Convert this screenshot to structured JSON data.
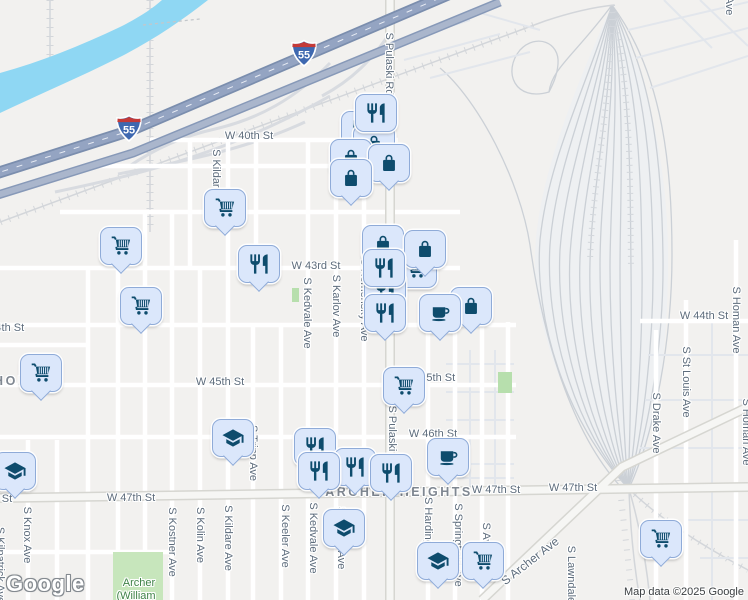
{
  "branding": {
    "logo": "Google",
    "attribution": "Map data ©2025 Google"
  },
  "route_shield": "55",
  "colors": {
    "land": "#f2f1ef",
    "water": "#8fd7f3",
    "park": "#c7e6bc",
    "highway": "#94a4c2",
    "pin_fill": "#dbe7fb",
    "pin_border": "#8fabd8",
    "pin_icon": "#0e4c6d",
    "street_label": "#5d6c7c",
    "neighborhood_label": "#7f8791"
  },
  "shields": [
    {
      "x": 304,
      "y": 56
    },
    {
      "x": 129,
      "y": 131
    }
  ],
  "labels": [
    {
      "text": "W 40th St",
      "x": 249,
      "y": 136,
      "dir": "h"
    },
    {
      "text": "W 43rd St",
      "x": 316,
      "y": 266,
      "dir": "h"
    },
    {
      "text": "W 44th St",
      "x": 0,
      "y": 328,
      "dir": "h"
    },
    {
      "text": "W 44th St",
      "x": 704,
      "y": 316,
      "dir": "h"
    },
    {
      "text": "W 45th St",
      "x": 220,
      "y": 382,
      "dir": "h"
    },
    {
      "text": "W 45th St",
      "x": 431,
      "y": 378,
      "dir": "h"
    },
    {
      "text": "W 46th St",
      "x": 433,
      "y": 434,
      "dir": "h"
    },
    {
      "text": "W 47th St",
      "x": -12,
      "y": 499,
      "dir": "h"
    },
    {
      "text": "W 47th St",
      "x": 131,
      "y": 498,
      "dir": "h"
    },
    {
      "text": "W 47th St",
      "x": 496,
      "y": 490,
      "dir": "h"
    },
    {
      "text": "W 47th St",
      "x": 573,
      "y": 488,
      "dir": "h"
    },
    {
      "text": "S Pulaski Rd",
      "x": 389,
      "y": 64,
      "dir": "v"
    },
    {
      "text": "S Pulaski Rd",
      "x": 392,
      "y": 437,
      "dir": "v"
    },
    {
      "text": "S Kildare Ave",
      "x": 216,
      "y": 182,
      "dir": "v"
    },
    {
      "text": "S Kedvale Ave",
      "x": 307,
      "y": 313,
      "dir": "v"
    },
    {
      "text": "S Karlov Ave",
      "x": 336,
      "y": 306,
      "dir": "v"
    },
    {
      "text": "S Komensky Ave",
      "x": 364,
      "y": 300,
      "dir": "v"
    },
    {
      "text": "S Tripp Ave",
      "x": 253,
      "y": 453,
      "dir": "v"
    },
    {
      "text": "S Knox Ave",
      "x": 27,
      "y": 535,
      "dir": "v"
    },
    {
      "text": "S Kilpatrick Ave",
      "x": 0,
      "y": 565,
      "dir": "v"
    },
    {
      "text": "S Kostner Ave",
      "x": 172,
      "y": 542,
      "dir": "v"
    },
    {
      "text": "S Kolin Ave",
      "x": 200,
      "y": 535,
      "dir": "v"
    },
    {
      "text": "S Kildare Ave",
      "x": 228,
      "y": 538,
      "dir": "v"
    },
    {
      "text": "S Keeler Ave",
      "x": 285,
      "y": 536,
      "dir": "v"
    },
    {
      "text": "S Kedvale Ave",
      "x": 313,
      "y": 538,
      "dir": "v"
    },
    {
      "text": "S Karlov Ave",
      "x": 341,
      "y": 538,
      "dir": "v"
    },
    {
      "text": "S Harding Ave",
      "x": 428,
      "y": 532,
      "dir": "v"
    },
    {
      "text": "S Springfield Ave",
      "x": 458,
      "y": 545,
      "dir": "v"
    },
    {
      "text": "S Avers Ave",
      "x": 486,
      "y": 552,
      "dir": "v"
    },
    {
      "text": "S Lawndale Ave",
      "x": 571,
      "y": 585,
      "dir": "v"
    },
    {
      "text": "S Drake Ave",
      "x": 656,
      "y": 423,
      "dir": "v"
    },
    {
      "text": "S St Louis Ave",
      "x": 686,
      "y": 382,
      "dir": "v"
    },
    {
      "text": "S Homan Ave",
      "x": 736,
      "y": 320,
      "dir": "v"
    },
    {
      "text": "S Homan Ave",
      "x": 746,
      "y": 432,
      "dir": "v"
    },
    {
      "text": "Ave",
      "x": 729,
      "y": 6,
      "dir": "v"
    },
    {
      "text": "S Archer Ave",
      "x": 530,
      "y": 561,
      "dir": "h",
      "angle": -38,
      "cls": "street-lg"
    },
    {
      "text": "ARCHER HEIGHTS",
      "x": 399,
      "y": 492,
      "dir": "h",
      "cls": "nbhd"
    },
    {
      "text": "HOL",
      "x": 11,
      "y": 381,
      "dir": "h",
      "cls": "nbhd"
    },
    {
      "text": "Archer",
      "x": 139,
      "y": 583,
      "dir": "h",
      "cls": "park"
    },
    {
      "text": "(William",
      "x": 136,
      "y": 596,
      "dir": "h",
      "cls": "park"
    }
  ],
  "markers": [
    {
      "type": "restaurant",
      "x": 375,
      "y": 112,
      "z": 9,
      "tail": false
    },
    {
      "type": "restaurant",
      "x": 361,
      "y": 129,
      "z": 4
    },
    {
      "type": "bag",
      "x": 373,
      "y": 143,
      "z": 5,
      "tail": false
    },
    {
      "type": "bag",
      "x": 350,
      "y": 157,
      "z": 6,
      "tail": false
    },
    {
      "type": "bag",
      "x": 388,
      "y": 162,
      "z": 7
    },
    {
      "type": "bag",
      "x": 350,
      "y": 177,
      "z": 8
    },
    {
      "type": "bag",
      "x": 382,
      "y": 243,
      "z": 1,
      "tail": false
    },
    {
      "type": "cart",
      "x": 415,
      "y": 268,
      "z": 2,
      "tail": false
    },
    {
      "type": "restaurant",
      "x": 384,
      "y": 289,
      "z": 3,
      "tail": false
    },
    {
      "type": "bag",
      "x": 424,
      "y": 248,
      "z": 4
    },
    {
      "type": "restaurant",
      "x": 383,
      "y": 267,
      "z": 6,
      "tail": false
    },
    {
      "type": "bag",
      "x": 470,
      "y": 305,
      "z": 5
    },
    {
      "type": "cafe",
      "x": 439,
      "y": 312,
      "z": 7
    },
    {
      "type": "restaurant",
      "x": 384,
      "y": 312,
      "z": 8
    },
    {
      "type": "cart",
      "x": 224,
      "y": 207,
      "z": 3
    },
    {
      "type": "cart",
      "x": 120,
      "y": 245,
      "z": 3
    },
    {
      "type": "cart",
      "x": 140,
      "y": 305,
      "z": 3
    },
    {
      "type": "restaurant",
      "x": 258,
      "y": 263,
      "z": 3
    },
    {
      "type": "cart",
      "x": 40,
      "y": 372,
      "z": 3
    },
    {
      "type": "cart",
      "x": 403,
      "y": 385,
      "z": 6
    },
    {
      "type": "school",
      "x": 232,
      "y": 437,
      "z": 2
    },
    {
      "type": "restaurant",
      "x": 314,
      "y": 446,
      "z": 1
    },
    {
      "type": "restaurant",
      "x": 354,
      "y": 466,
      "z": 2
    },
    {
      "type": "restaurant",
      "x": 318,
      "y": 470,
      "z": 4
    },
    {
      "type": "restaurant",
      "x": 390,
      "y": 472,
      "z": 5
    },
    {
      "type": "cafe",
      "x": 447,
      "y": 456,
      "z": 3
    },
    {
      "type": "school",
      "x": 14,
      "y": 470,
      "z": 2
    },
    {
      "type": "school",
      "x": 343,
      "y": 527,
      "z": 3
    },
    {
      "type": "school",
      "x": 437,
      "y": 560,
      "z": 3
    },
    {
      "type": "cart",
      "x": 482,
      "y": 560,
      "z": 4
    },
    {
      "type": "cart",
      "x": 660,
      "y": 538,
      "z": 3
    }
  ]
}
